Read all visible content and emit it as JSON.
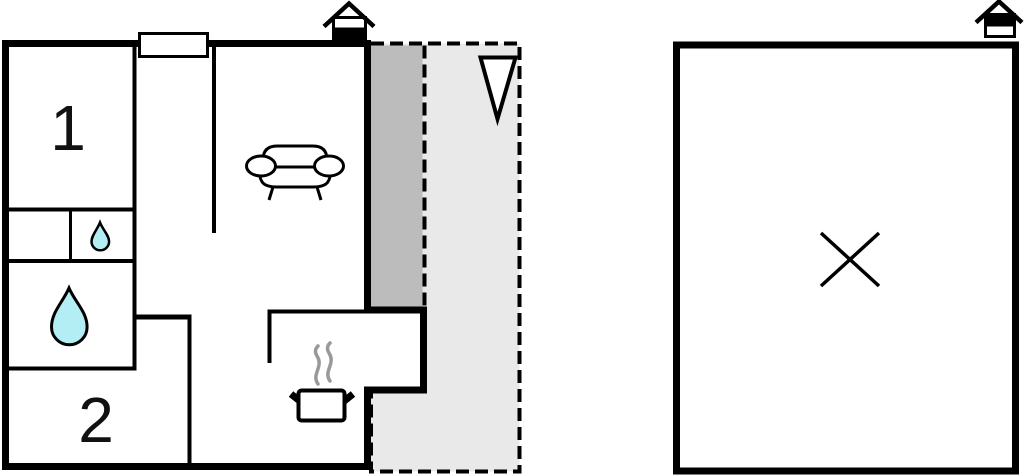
{
  "page": {
    "background": "#ffffff"
  },
  "colors": {
    "wall": "#000000",
    "interior_fill": "#ffffff",
    "terrace_open": "#e9e9e9",
    "terrace_covered": "#bcbcbc",
    "water_drop": "#b4eef5",
    "steam": "#999999",
    "text": "#111111"
  },
  "left_plan": {
    "title": "ground-floor-plan",
    "rooms": [
      {
        "id": "room-1",
        "label": "1"
      },
      {
        "id": "room-2",
        "label": "2"
      }
    ],
    "icons": [
      {
        "name": "house-level-indicator-ground"
      },
      {
        "name": "window"
      },
      {
        "name": "sofa"
      },
      {
        "name": "cooking-pot-with-steam"
      },
      {
        "name": "water-drop-small"
      },
      {
        "name": "water-drop-large"
      },
      {
        "name": "north-arrow-triangle"
      },
      {
        "name": "covered-terrace-strip"
      },
      {
        "name": "open-terrace-dashed"
      }
    ]
  },
  "right_plan": {
    "title": "upper-floor-plan",
    "icons": [
      {
        "name": "house-level-indicator-upper"
      },
      {
        "name": "x-marker"
      }
    ]
  }
}
